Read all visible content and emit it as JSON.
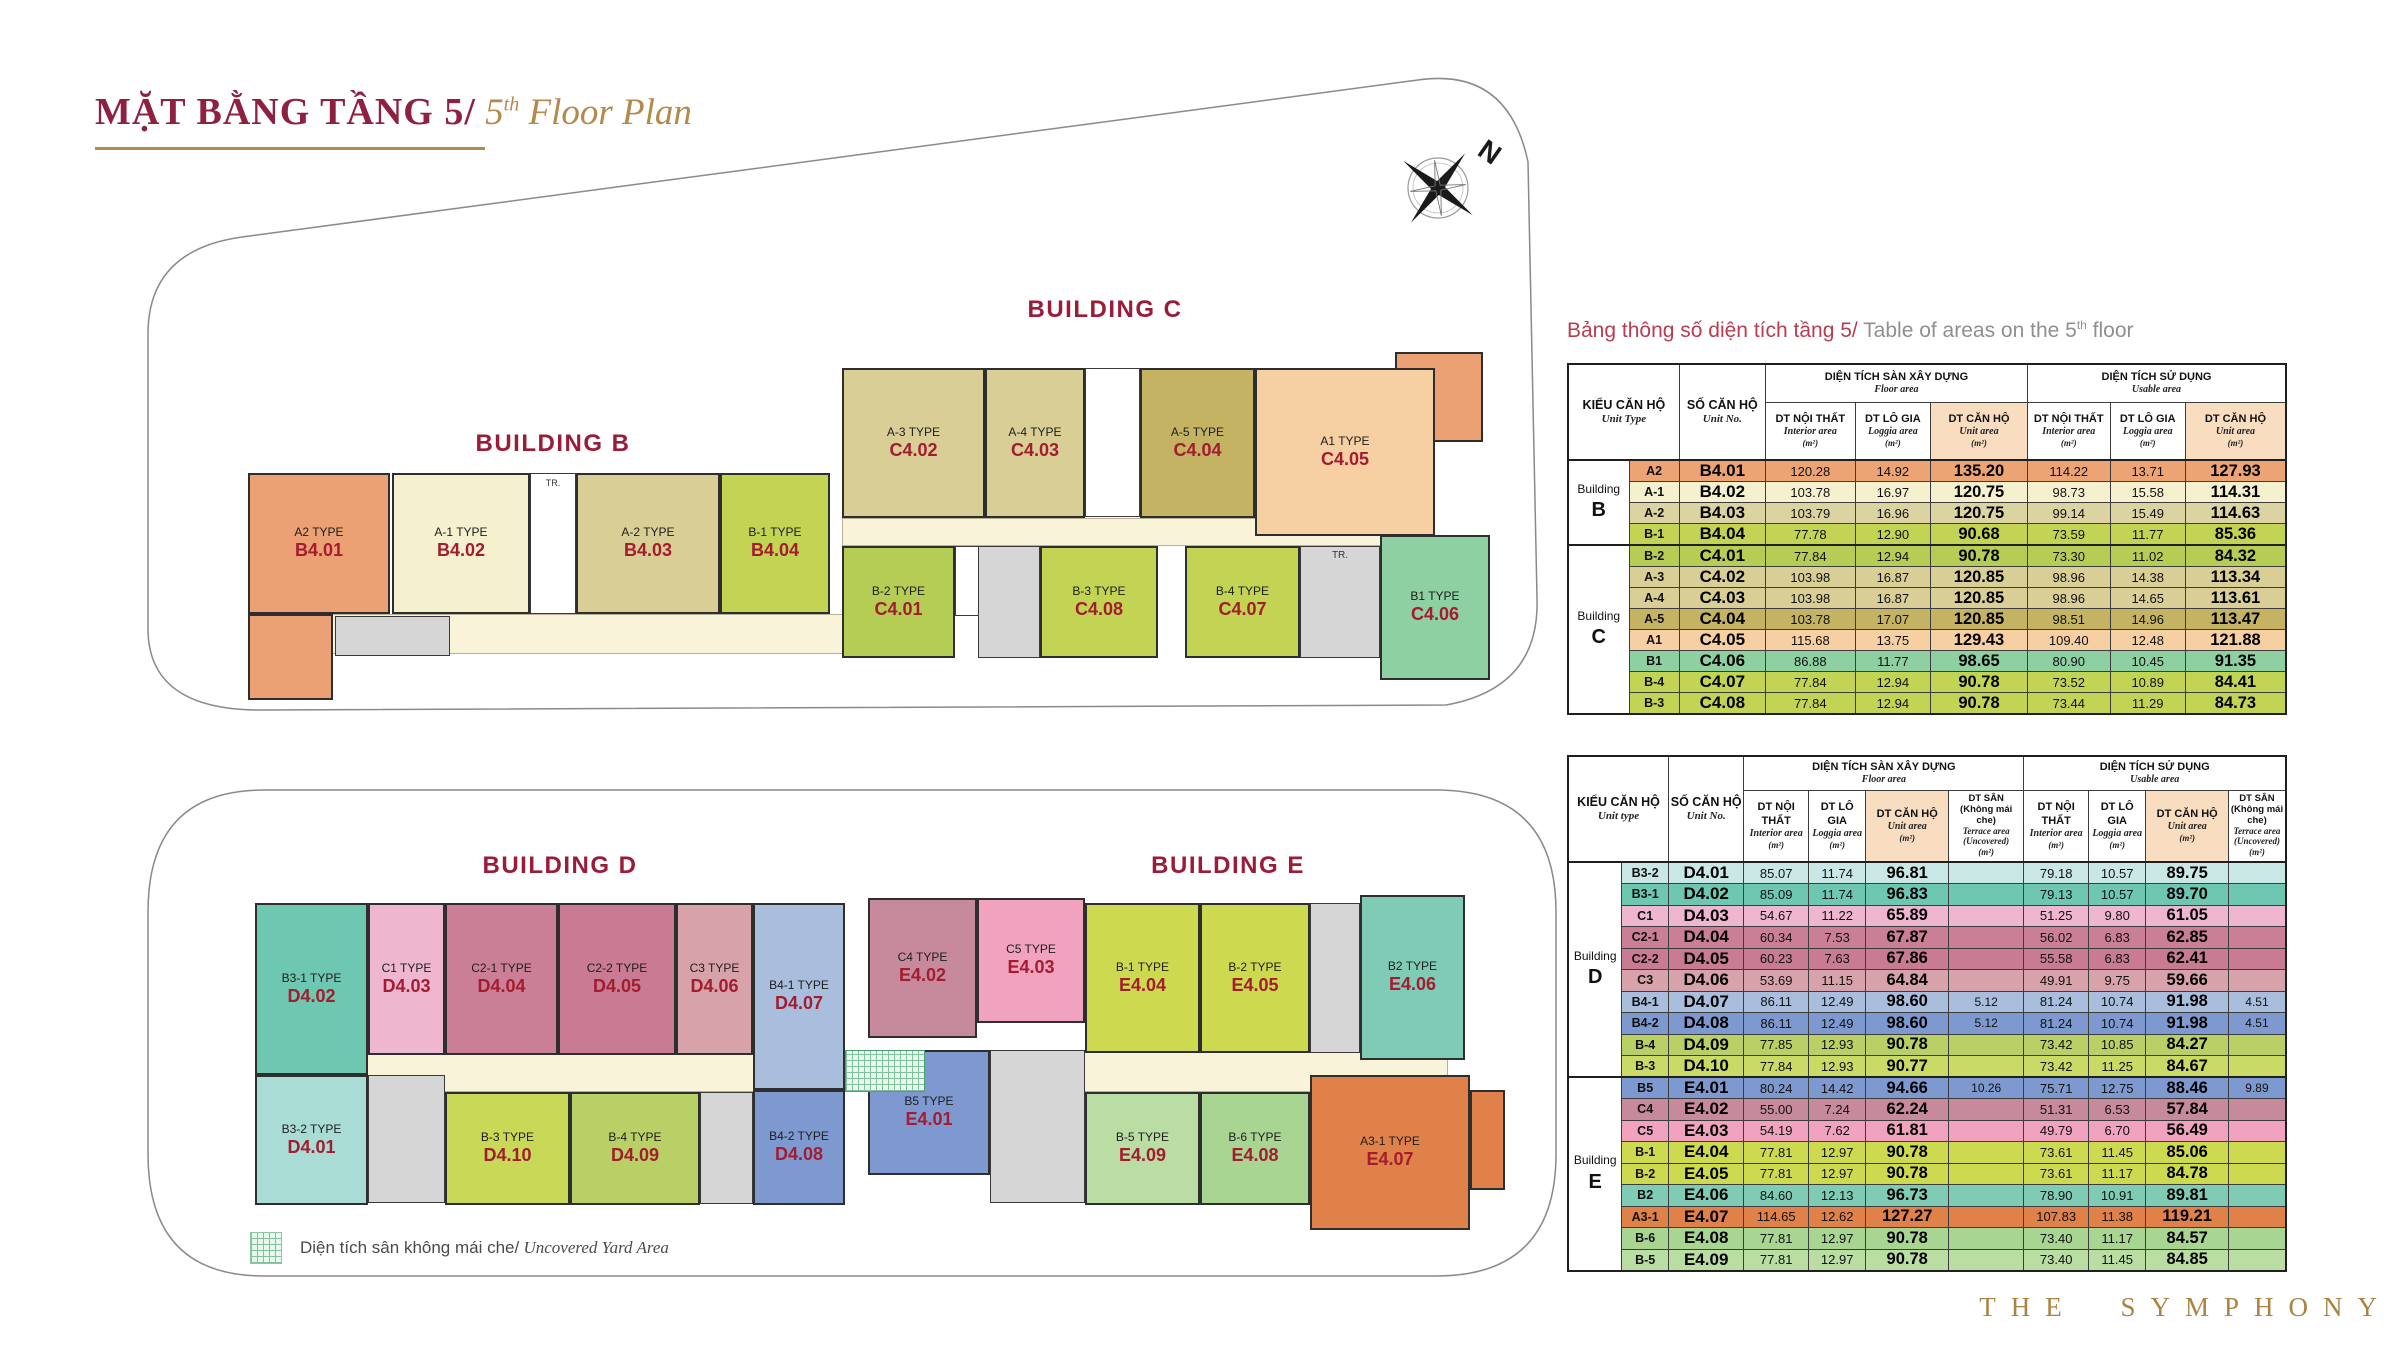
{
  "title": {
    "vi": "MẶT BẰNG TẦNG 5/",
    "en_num": " 5",
    "en_sup": "th",
    "en_rest": " Floor Plan"
  },
  "brand": "THE SYMPHONY",
  "compass": {
    "label": "N"
  },
  "legend": {
    "vi": "Diện tích sân không mái che/",
    "en": " Uncovered Yard Area"
  },
  "plan": {
    "building_labels": [
      {
        "text": "BUILDING B",
        "x": 553,
        "y": 430
      },
      {
        "text": "BUILDING C",
        "x": 1105,
        "y": 296
      },
      {
        "text": "BUILDING D",
        "x": 560,
        "y": 852
      },
      {
        "text": "BUILDING E",
        "x": 1228,
        "y": 852
      }
    ],
    "corridors": [
      {
        "x": 300,
        "y": 614,
        "w": 545,
        "h": 40
      },
      {
        "x": 842,
        "y": 518,
        "w": 593,
        "h": 28
      },
      {
        "x": 278,
        "y": 1050,
        "w": 1170,
        "h": 42
      }
    ],
    "cores": [
      {
        "x": 335,
        "y": 616,
        "w": 115,
        "h": 40,
        "label": ""
      },
      {
        "x": 978,
        "y": 546,
        "w": 62,
        "h": 112,
        "label": ""
      },
      {
        "x": 1300,
        "y": 546,
        "w": 80,
        "h": 112,
        "label": "TR."
      },
      {
        "x": 368,
        "y": 1075,
        "w": 77,
        "h": 128,
        "label": ""
      },
      {
        "x": 700,
        "y": 1092,
        "w": 53,
        "h": 112,
        "label": ""
      },
      {
        "x": 1310,
        "y": 903,
        "w": 50,
        "h": 150,
        "label": ""
      },
      {
        "x": 990,
        "y": 1050,
        "w": 95,
        "h": 153,
        "label": ""
      }
    ],
    "shafts": [
      {
        "x": 530,
        "y": 473,
        "w": 46,
        "h": 141,
        "label": "TR."
      },
      {
        "x": 1085,
        "y": 368,
        "w": 55,
        "h": 149,
        "label": ""
      },
      {
        "x": 955,
        "y": 546,
        "w": 24,
        "h": 70,
        "label": ""
      }
    ],
    "extras": [
      {
        "x": 248,
        "y": 614,
        "w": 85,
        "h": 86,
        "color": "#eba173"
      },
      {
        "x": 1395,
        "y": 352,
        "w": 88,
        "h": 90,
        "color": "#eba173"
      },
      {
        "x": 1470,
        "y": 1090,
        "w": 35,
        "h": 100,
        "color": "#e0814a"
      }
    ],
    "yard": {
      "x": 845,
      "y": 1050,
      "w": 80,
      "h": 42
    },
    "units": [
      {
        "type": "A2 TYPE",
        "code": "B4.01",
        "color": "#eba173",
        "x": 248,
        "y": 473,
        "w": 142,
        "h": 141
      },
      {
        "type": "A-1 TYPE",
        "code": "B4.02",
        "color": "#f5f1cf",
        "x": 392,
        "y": 473,
        "w": 138,
        "h": 141
      },
      {
        "type": "A-2 TYPE",
        "code": "B4.03",
        "color": "#d9cf96",
        "x": 576,
        "y": 473,
        "w": 144,
        "h": 141
      },
      {
        "type": "B-1 TYPE",
        "code": "B4.04",
        "color": "#c3d455",
        "x": 720,
        "y": 473,
        "w": 110,
        "h": 141
      },
      {
        "type": "A-3 TYPE",
        "code": "C4.02",
        "color": "#d9cf96",
        "x": 842,
        "y": 368,
        "w": 143,
        "h": 150
      },
      {
        "type": "A-4 TYPE",
        "code": "C4.03",
        "color": "#d9cf96",
        "x": 985,
        "y": 368,
        "w": 100,
        "h": 150
      },
      {
        "type": "A-5 TYPE",
        "code": "C4.04",
        "color": "#c4b363",
        "x": 1140,
        "y": 368,
        "w": 115,
        "h": 150
      },
      {
        "type": "A1 TYPE",
        "code": "C4.05",
        "color": "#f6cfa3",
        "x": 1255,
        "y": 368,
        "w": 180,
        "h": 168
      },
      {
        "type": "B-2 TYPE",
        "code": "C4.01",
        "color": "#b5cd55",
        "x": 842,
        "y": 546,
        "w": 113,
        "h": 112
      },
      {
        "type": "B-3 TYPE",
        "code": "C4.08",
        "color": "#c3d455",
        "x": 1040,
        "y": 546,
        "w": 118,
        "h": 112
      },
      {
        "type": "B-4 TYPE",
        "code": "C4.07",
        "color": "#c3d455",
        "x": 1185,
        "y": 546,
        "w": 115,
        "h": 112
      },
      {
        "type": "B1 TYPE",
        "code": "C4.06",
        "color": "#8ed0a2",
        "x": 1380,
        "y": 535,
        "w": 110,
        "h": 145
      },
      {
        "type": "B3-1 TYPE",
        "code": "D4.02",
        "color": "#6ec7b1",
        "x": 255,
        "y": 903,
        "w": 113,
        "h": 172
      },
      {
        "type": "C1 TYPE",
        "code": "D4.03",
        "color": "#efb6d0",
        "x": 368,
        "y": 903,
        "w": 77,
        "h": 152
      },
      {
        "type": "C2-1 TYPE",
        "code": "D4.04",
        "color": "#cb7f97",
        "x": 445,
        "y": 903,
        "w": 113,
        "h": 152
      },
      {
        "type": "C2-2 TYPE",
        "code": "D4.05",
        "color": "#c87b93",
        "x": 558,
        "y": 903,
        "w": 118,
        "h": 152
      },
      {
        "type": "C3 TYPE",
        "code": "D4.06",
        "color": "#d8a2ab",
        "x": 676,
        "y": 903,
        "w": 77,
        "h": 152
      },
      {
        "type": "B4-1 TYPE",
        "code": "D4.07",
        "color": "#a9bedd",
        "x": 753,
        "y": 903,
        "w": 92,
        "h": 187
      },
      {
        "type": "B3-2 TYPE",
        "code": "D4.01",
        "color": "#aadcd6",
        "x": 255,
        "y": 1075,
        "w": 113,
        "h": 130
      },
      {
        "type": "B-3 TYPE",
        "code": "D4.10",
        "color": "#c8d957",
        "x": 445,
        "y": 1092,
        "w": 125,
        "h": 113
      },
      {
        "type": "B-4 TYPE",
        "code": "D4.09",
        "color": "#b8d065",
        "x": 570,
        "y": 1092,
        "w": 130,
        "h": 113
      },
      {
        "type": "B4-2 TYPE",
        "code": "D4.08",
        "color": "#7e99d0",
        "x": 753,
        "y": 1090,
        "w": 92,
        "h": 115
      },
      {
        "type": "C4 TYPE",
        "code": "E4.02",
        "color": "#c78a9c",
        "x": 868,
        "y": 898,
        "w": 109,
        "h": 140
      },
      {
        "type": "C5 TYPE",
        "code": "E4.03",
        "color": "#f1a2be",
        "x": 977,
        "y": 898,
        "w": 108,
        "h": 125
      },
      {
        "type": "B-1 TYPE",
        "code": "E4.04",
        "color": "#cdda4f",
        "x": 1085,
        "y": 903,
        "w": 115,
        "h": 150
      },
      {
        "type": "B-2 TYPE",
        "code": "E4.05",
        "color": "#cdda4f",
        "x": 1200,
        "y": 903,
        "w": 110,
        "h": 150
      },
      {
        "type": "B2 TYPE",
        "code": "E4.06",
        "color": "#7fcbb5",
        "x": 1360,
        "y": 895,
        "w": 105,
        "h": 165
      },
      {
        "type": "B5 TYPE",
        "code": "E4.01",
        "color": "#7e99d0",
        "x": 868,
        "y": 1050,
        "w": 122,
        "h": 125
      },
      {
        "type": "B-5 TYPE",
        "code": "E4.09",
        "color": "#b9dda3",
        "x": 1085,
        "y": 1092,
        "w": 115,
        "h": 113
      },
      {
        "type": "B-6 TYPE",
        "code": "E4.08",
        "color": "#a8d592",
        "x": 1200,
        "y": 1092,
        "w": 110,
        "h": 113
      },
      {
        "type": "A3-1 TYPE",
        "code": "E4.07",
        "color": "#e0814a",
        "x": 1310,
        "y": 1075,
        "w": 160,
        "h": 155
      }
    ]
  },
  "table1": {
    "title_vi": "Bảng thông số diện tích tầng 5/",
    "title_en": " Table of areas on the 5",
    "title_sup": "th",
    "title_rest": " floor",
    "col_widths": [
      8.5,
      7,
      12,
      12.5,
      10.5,
      13.5,
      11.5,
      10.5,
      14
    ],
    "header": {
      "unit_type_vi": "KIỂU CĂN HỘ",
      "unit_type_en": "Unit Type",
      "unit_no_vi": "SỐ CĂN HỘ",
      "unit_no_en": "Unit No.",
      "floor_vi": "DIỆN TÍCH SÀN XÂY DỰNG",
      "floor_en": "Floor area",
      "usable_vi": "DIỆN TÍCH SỬ DỤNG",
      "usable_en": "Usable area",
      "interior_vi": "DT NỘI THẤT",
      "interior_en": "Interior area",
      "loggia_vi": "DT LÔ GIA",
      "loggia_en": "Loggia area",
      "unit_area_vi": "DT CĂN HỘ",
      "unit_area_en": "Unit area",
      "sqm": "(m²)"
    },
    "groups": [
      {
        "name": "Building",
        "letter": "B",
        "rows": [
          {
            "type": "A2",
            "no": "B4.01",
            "color": "#eca475",
            "vals": [
              "120.28",
              "14.92",
              "135.20",
              "114.22",
              "13.71",
              "127.93"
            ]
          },
          {
            "type": "A-1",
            "no": "B4.02",
            "color": "#f5f1cf",
            "vals": [
              "103.78",
              "16.97",
              "120.75",
              "98.73",
              "15.58",
              "114.31"
            ]
          },
          {
            "type": "A-2",
            "no": "B4.03",
            "color": "#dbd3a2",
            "vals": [
              "103.79",
              "16.96",
              "120.75",
              "99.14",
              "15.49",
              "114.63"
            ]
          },
          {
            "type": "B-1",
            "no": "B4.04",
            "color": "#c3d455",
            "vals": [
              "77.78",
              "12.90",
              "90.68",
              "73.59",
              "11.77",
              "85.36"
            ]
          }
        ]
      },
      {
        "name": "Building",
        "letter": "C",
        "rows": [
          {
            "type": "B-2",
            "no": "C4.01",
            "color": "#b5cd55",
            "vals": [
              "77.84",
              "12.94",
              "90.78",
              "73.30",
              "11.02",
              "84.32"
            ]
          },
          {
            "type": "A-3",
            "no": "C4.02",
            "color": "#d9cf96",
            "vals": [
              "103.98",
              "16.87",
              "120.85",
              "98.96",
              "14.38",
              "113.34"
            ]
          },
          {
            "type": "A-4",
            "no": "C4.03",
            "color": "#d9cf96",
            "vals": [
              "103.98",
              "16.87",
              "120.85",
              "98.96",
              "14.65",
              "113.61"
            ]
          },
          {
            "type": "A-5",
            "no": "C4.04",
            "color": "#c4b363",
            "vals": [
              "103.78",
              "17.07",
              "120.85",
              "98.51",
              "14.96",
              "113.47"
            ]
          },
          {
            "type": "A1",
            "no": "C4.05",
            "color": "#f6cfa3",
            "vals": [
              "115.68",
              "13.75",
              "129.43",
              "109.40",
              "12.48",
              "121.88"
            ]
          },
          {
            "type": "B1",
            "no": "C4.06",
            "color": "#8ed0a2",
            "vals": [
              "86.88",
              "11.77",
              "98.65",
              "80.90",
              "10.45",
              "91.35"
            ]
          },
          {
            "type": "B-4",
            "no": "C4.07",
            "color": "#c3d455",
            "vals": [
              "77.84",
              "12.94",
              "90.78",
              "73.52",
              "10.89",
              "84.41"
            ]
          },
          {
            "type": "B-3",
            "no": "C4.08",
            "color": "#c3d455",
            "vals": [
              "77.84",
              "12.94",
              "90.78",
              "73.44",
              "11.29",
              "84.73"
            ]
          }
        ]
      }
    ]
  },
  "table2": {
    "col_widths": [
      7.5,
      6.5,
      10.5,
      9,
      8,
      11.5,
      10.5,
      9,
      8,
      11.5,
      8
    ],
    "header": {
      "unit_type_vi": "KIỂU CĂN HỘ",
      "unit_type_en": "Unit type",
      "unit_no_vi": "SỐ CĂN HỘ",
      "unit_no_en": "Unit No.",
      "floor_vi": "DIỆN TÍCH SÀN XÂY DỰNG",
      "floor_en": "Floor area",
      "usable_vi": "DIỆN TÍCH SỬ DỤNG",
      "usable_en": "Usable area",
      "interior_vi": "DT NỘI THẤT",
      "interior_en": "Interior area",
      "loggia_vi": "DT LÔ GIA",
      "loggia_en": "Loggia area",
      "unit_area_vi": "DT CĂN HỘ",
      "unit_area_en": "Unit area",
      "terrace_vi": "DT SÂN",
      "terrace_vi2": "(Không mái che)",
      "terrace_en": "Terrace area",
      "terrace_en2": "(Uncovered)",
      "sqm": "(m²)"
    },
    "groups": [
      {
        "name": "Building",
        "letter": "D",
        "rows": [
          {
            "type": "B3-2",
            "no": "D4.01",
            "color": "#c9e7e4",
            "vals": [
              "85.07",
              "11.74",
              "96.81",
              "",
              "79.18",
              "10.57",
              "89.75",
              ""
            ]
          },
          {
            "type": "B3-1",
            "no": "D4.02",
            "color": "#6ec7b1",
            "vals": [
              "85.09",
              "11.74",
              "96.83",
              "",
              "79.13",
              "10.57",
              "89.70",
              ""
            ]
          },
          {
            "type": "C1",
            "no": "D4.03",
            "color": "#efb6d0",
            "vals": [
              "54.67",
              "11.22",
              "65.89",
              "",
              "51.25",
              "9.80",
              "61.05",
              ""
            ]
          },
          {
            "type": "C2-1",
            "no": "D4.04",
            "color": "#cb7f97",
            "vals": [
              "60.34",
              "7.53",
              "67.87",
              "",
              "56.02",
              "6.83",
              "62.85",
              ""
            ]
          },
          {
            "type": "C2-2",
            "no": "D4.05",
            "color": "#c87b93",
            "vals": [
              "60.23",
              "7.63",
              "67.86",
              "",
              "55.58",
              "6.83",
              "62.41",
              ""
            ]
          },
          {
            "type": "C3",
            "no": "D4.06",
            "color": "#d8a2ab",
            "vals": [
              "53.69",
              "11.15",
              "64.84",
              "",
              "49.91",
              "9.75",
              "59.66",
              ""
            ]
          },
          {
            "type": "B4-1",
            "no": "D4.07",
            "color": "#a9bedd",
            "vals": [
              "86.11",
              "12.49",
              "98.60",
              "5.12",
              "81.24",
              "10.74",
              "91.98",
              "4.51"
            ]
          },
          {
            "type": "B4-2",
            "no": "D4.08",
            "color": "#7e99d0",
            "vals": [
              "86.11",
              "12.49",
              "98.60",
              "5.12",
              "81.24",
              "10.74",
              "91.98",
              "4.51"
            ]
          },
          {
            "type": "B-4",
            "no": "D4.09",
            "color": "#b8d065",
            "vals": [
              "77.85",
              "12.93",
              "90.78",
              "",
              "73.42",
              "10.85",
              "84.27",
              ""
            ]
          },
          {
            "type": "B-3",
            "no": "D4.10",
            "color": "#c9da66",
            "vals": [
              "77.84",
              "12.93",
              "90.77",
              "",
              "73.42",
              "11.25",
              "84.67",
              ""
            ]
          }
        ]
      },
      {
        "name": "Building",
        "letter": "E",
        "rows": [
          {
            "type": "B5",
            "no": "E4.01",
            "color": "#7e99d0",
            "vals": [
              "80.24",
              "14.42",
              "94.66",
              "10.26",
              "75.71",
              "12.75",
              "88.46",
              "9.89"
            ]
          },
          {
            "type": "C4",
            "no": "E4.02",
            "color": "#c78a9c",
            "vals": [
              "55.00",
              "7.24",
              "62.24",
              "",
              "51.31",
              "6.53",
              "57.84",
              ""
            ]
          },
          {
            "type": "C5",
            "no": "E4.03",
            "color": "#f1a2be",
            "vals": [
              "54.19",
              "7.62",
              "61.81",
              "",
              "49.79",
              "6.70",
              "56.49",
              ""
            ]
          },
          {
            "type": "B-1",
            "no": "E4.04",
            "color": "#cdd94e",
            "vals": [
              "77.81",
              "12.97",
              "90.78",
              "",
              "73.61",
              "11.45",
              "85.06",
              ""
            ]
          },
          {
            "type": "B-2",
            "no": "E4.05",
            "color": "#cdd94e",
            "vals": [
              "77.81",
              "12.97",
              "90.78",
              "",
              "73.61",
              "11.17",
              "84.78",
              ""
            ]
          },
          {
            "type": "B2",
            "no": "E4.06",
            "color": "#7fcbb5",
            "vals": [
              "84.60",
              "12.13",
              "96.73",
              "",
              "78.90",
              "10.91",
              "89.81",
              ""
            ]
          },
          {
            "type": "A3-1",
            "no": "E4.07",
            "color": "#e0814a",
            "vals": [
              "114.65",
              "12.62",
              "127.27",
              "",
              "107.83",
              "11.38",
              "119.21",
              ""
            ]
          },
          {
            "type": "B-6",
            "no": "E4.08",
            "color": "#a8d592",
            "vals": [
              "77.81",
              "12.97",
              "90.78",
              "",
              "73.40",
              "11.17",
              "84.57",
              ""
            ]
          },
          {
            "type": "B-5",
            "no": "E4.09",
            "color": "#b9dda3",
            "vals": [
              "77.81",
              "12.97",
              "90.78",
              "",
              "73.40",
              "11.45",
              "84.85",
              ""
            ]
          }
        ]
      }
    ]
  }
}
